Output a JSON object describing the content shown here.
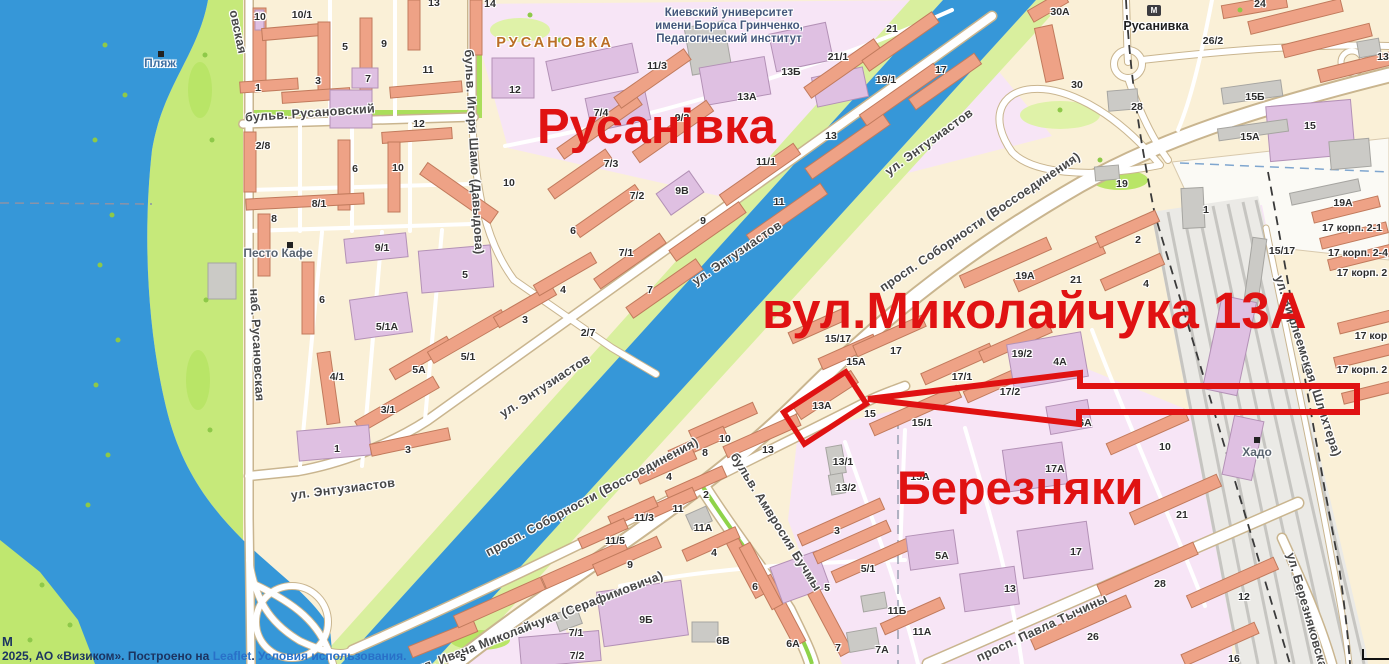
{
  "annotations": {
    "rusanivka_text": "Русанівка",
    "street_text": "вул.Миколайчука 13А",
    "bereznyaky_text": "Березняки",
    "color": "#e01212"
  },
  "attribution": {
    "m": "М",
    "prefix": "2025, АО «Визиком». Построено на ",
    "leaflet_link": "Leaflet",
    "separator": ". ",
    "terms_link": "Условия использования."
  },
  "map_labels": [
    {
      "t": "бульв. Русановский",
      "x": 310,
      "y": 113,
      "k": "st",
      "r": -4
    },
    {
      "t": "наб. Русановская",
      "x": 257,
      "y": 345,
      "k": "st",
      "r": 87
    },
    {
      "t": "овская",
      "x": 238,
      "y": 32,
      "k": "st",
      "r": 78
    },
    {
      "t": "бульв. Игоря Шамо (Давыдова)",
      "x": 474,
      "y": 152,
      "k": "st",
      "r": 87
    },
    {
      "t": "ул. Энтузиастов",
      "x": 929,
      "y": 142,
      "k": "st",
      "r": -36
    },
    {
      "t": "ул. Энтузиастов",
      "x": 737,
      "y": 253,
      "k": "st",
      "r": -34
    },
    {
      "t": "ул. Энтузиастов",
      "x": 545,
      "y": 386,
      "k": "st",
      "r": -33
    },
    {
      "t": "ул. Энтузиастов",
      "x": 343,
      "y": 489,
      "k": "st",
      "r": -7
    },
    {
      "t": "просп. Соборности (Воссоединения)",
      "x": 980,
      "y": 222,
      "k": "st",
      "r": -34
    },
    {
      "t": "просп. Соборности (Воссоединения)",
      "x": 592,
      "y": 497,
      "k": "st",
      "r": -28
    },
    {
      "t": "бульв. Амвросия Бучмы",
      "x": 776,
      "y": 522,
      "k": "st",
      "r": 58
    },
    {
      "t": "ул. Ивана Миколайчука (Серафимовича)",
      "x": 540,
      "y": 622,
      "k": "st",
      "r": -21
    },
    {
      "t": "просп. Павла Тычины",
      "x": 1042,
      "y": 628,
      "k": "st",
      "r": -25
    },
    {
      "t": "ул. Березняковская",
      "x": 1308,
      "y": 614,
      "k": "st",
      "r": 74
    },
    {
      "t": "ул. Вифлеемская (Шлихтера)",
      "x": 1308,
      "y": 366,
      "k": "st",
      "r": 72
    },
    {
      "t": "РУСАНОВКА",
      "x": 555,
      "y": 43,
      "k": "dist"
    },
    {
      "t": "Киевский университет",
      "x": 729,
      "y": 13,
      "k": "uni"
    },
    {
      "t": "имени Бориса Гринченко,",
      "x": 729,
      "y": 26,
      "k": "uni"
    },
    {
      "t": "Педагогический институт",
      "x": 729,
      "y": 39,
      "k": "uni"
    },
    {
      "t": "Русанивка",
      "x": 1156,
      "y": 26,
      "k": "metro"
    },
    {
      "t": "Песто Кафе",
      "x": 278,
      "y": 253,
      "k": "poi"
    },
    {
      "t": "Хадо",
      "x": 1257,
      "y": 452,
      "k": "poi"
    },
    {
      "t": "Пляж",
      "x": 160,
      "y": 63,
      "k": "beach"
    },
    {
      "t": "10",
      "x": 260,
      "y": 17,
      "k": "n"
    },
    {
      "t": "10/1",
      "x": 302,
      "y": 15,
      "k": "n"
    },
    {
      "t": "5",
      "x": 345,
      "y": 47,
      "k": "n"
    },
    {
      "t": "9",
      "x": 384,
      "y": 44,
      "k": "n"
    },
    {
      "t": "13",
      "x": 434,
      "y": 3,
      "k": "n"
    },
    {
      "t": "14",
      "x": 490,
      "y": 4,
      "k": "n"
    },
    {
      "t": "1",
      "x": 258,
      "y": 88,
      "k": "n"
    },
    {
      "t": "3",
      "x": 318,
      "y": 81,
      "k": "n"
    },
    {
      "t": "7",
      "x": 368,
      "y": 79,
      "k": "n"
    },
    {
      "t": "11",
      "x": 428,
      "y": 70,
      "k": "n"
    },
    {
      "t": "12",
      "x": 515,
      "y": 90,
      "k": "n"
    },
    {
      "t": "2/8",
      "x": 263,
      "y": 146,
      "k": "n"
    },
    {
      "t": "12",
      "x": 419,
      "y": 124,
      "k": "n"
    },
    {
      "t": "6",
      "x": 355,
      "y": 169,
      "k": "n"
    },
    {
      "t": "10",
      "x": 398,
      "y": 168,
      "k": "n"
    },
    {
      "t": "8/1",
      "x": 319,
      "y": 204,
      "k": "n"
    },
    {
      "t": "8",
      "x": 274,
      "y": 219,
      "k": "n"
    },
    {
      "t": "10",
      "x": 509,
      "y": 183,
      "k": "n"
    },
    {
      "t": "9/1",
      "x": 382,
      "y": 248,
      "k": "n"
    },
    {
      "t": "11/3",
      "x": 657,
      "y": 66,
      "k": "n"
    },
    {
      "t": "7/4",
      "x": 601,
      "y": 113,
      "k": "n"
    },
    {
      "t": "9/2",
      "x": 682,
      "y": 118,
      "k": "n"
    },
    {
      "t": "13А",
      "x": 747,
      "y": 97,
      "k": "n"
    },
    {
      "t": "13Б",
      "x": 791,
      "y": 72,
      "k": "n"
    },
    {
      "t": "21/1",
      "x": 838,
      "y": 57,
      "k": "n"
    },
    {
      "t": "21",
      "x": 892,
      "y": 29,
      "k": "n"
    },
    {
      "t": "19/1",
      "x": 886,
      "y": 80,
      "k": "n"
    },
    {
      "t": "17",
      "x": 941,
      "y": 70,
      "k": "n"
    },
    {
      "t": "13",
      "x": 831,
      "y": 136,
      "k": "n"
    },
    {
      "t": "11/1",
      "x": 766,
      "y": 162,
      "k": "n"
    },
    {
      "t": "7/3",
      "x": 611,
      "y": 164,
      "k": "n"
    },
    {
      "t": "7/2",
      "x": 637,
      "y": 196,
      "k": "n"
    },
    {
      "t": "9В",
      "x": 682,
      "y": 191,
      "k": "n"
    },
    {
      "t": "11",
      "x": 779,
      "y": 202,
      "k": "n"
    },
    {
      "t": "9",
      "x": 703,
      "y": 221,
      "k": "n"
    },
    {
      "t": "7/1",
      "x": 626,
      "y": 253,
      "k": "n"
    },
    {
      "t": "7",
      "x": 650,
      "y": 290,
      "k": "n"
    },
    {
      "t": "6",
      "x": 573,
      "y": 231,
      "k": "n"
    },
    {
      "t": "2/7",
      "x": 588,
      "y": 333,
      "k": "n"
    },
    {
      "t": "5",
      "x": 465,
      "y": 275,
      "k": "n"
    },
    {
      "t": "6",
      "x": 322,
      "y": 300,
      "k": "n"
    },
    {
      "t": "5/1А",
      "x": 387,
      "y": 327,
      "k": "n"
    },
    {
      "t": "5А",
      "x": 419,
      "y": 370,
      "k": "n"
    },
    {
      "t": "5/1",
      "x": 468,
      "y": 357,
      "k": "n"
    },
    {
      "t": "3",
      "x": 525,
      "y": 320,
      "k": "n"
    },
    {
      "t": "4",
      "x": 563,
      "y": 290,
      "k": "n"
    },
    {
      "t": "4/1",
      "x": 337,
      "y": 377,
      "k": "n"
    },
    {
      "t": "3/1",
      "x": 388,
      "y": 410,
      "k": "n"
    },
    {
      "t": "1",
      "x": 337,
      "y": 449,
      "k": "n"
    },
    {
      "t": "3",
      "x": 408,
      "y": 450,
      "k": "n"
    },
    {
      "t": "15/17",
      "x": 838,
      "y": 339,
      "k": "n"
    },
    {
      "t": "19А",
      "x": 1025,
      "y": 276,
      "k": "n"
    },
    {
      "t": "21",
      "x": 1076,
      "y": 280,
      "k": "n"
    },
    {
      "t": "5",
      "x": 463,
      "y": 658,
      "k": "n"
    },
    {
      "t": "9",
      "x": 630,
      "y": 565,
      "k": "n"
    },
    {
      "t": "7/1",
      "x": 576,
      "y": 633,
      "k": "n"
    },
    {
      "t": "7/2",
      "x": 577,
      "y": 656,
      "k": "n"
    },
    {
      "t": "9Б",
      "x": 646,
      "y": 620,
      "k": "n"
    },
    {
      "t": "6В",
      "x": 723,
      "y": 641,
      "k": "n"
    },
    {
      "t": "6",
      "x": 755,
      "y": 587,
      "k": "n"
    },
    {
      "t": "6А",
      "x": 793,
      "y": 644,
      "k": "n"
    },
    {
      "t": "5",
      "x": 827,
      "y": 588,
      "k": "n"
    },
    {
      "t": "5/1",
      "x": 868,
      "y": 569,
      "k": "n"
    },
    {
      "t": "7",
      "x": 838,
      "y": 648,
      "k": "n"
    },
    {
      "t": "7А",
      "x": 882,
      "y": 650,
      "k": "n"
    },
    {
      "t": "11Б",
      "x": 897,
      "y": 611,
      "k": "n"
    },
    {
      "t": "11А",
      "x": 922,
      "y": 632,
      "k": "n"
    },
    {
      "t": "10",
      "x": 725,
      "y": 439,
      "k": "n"
    },
    {
      "t": "8",
      "x": 705,
      "y": 453,
      "k": "n"
    },
    {
      "t": "13",
      "x": 768,
      "y": 450,
      "k": "n"
    },
    {
      "t": "4",
      "x": 669,
      "y": 477,
      "k": "n"
    },
    {
      "t": "2",
      "x": 706,
      "y": 495,
      "k": "n"
    },
    {
      "t": "11",
      "x": 678,
      "y": 509,
      "k": "n"
    },
    {
      "t": "11/3",
      "x": 644,
      "y": 518,
      "k": "n"
    },
    {
      "t": "11/5",
      "x": 615,
      "y": 541,
      "k": "n"
    },
    {
      "t": "11А",
      "x": 703,
      "y": 528,
      "k": "n"
    },
    {
      "t": "4",
      "x": 714,
      "y": 553,
      "k": "n"
    },
    {
      "t": "13/1",
      "x": 843,
      "y": 462,
      "k": "n"
    },
    {
      "t": "13/2",
      "x": 846,
      "y": 488,
      "k": "n"
    },
    {
      "t": "3",
      "x": 837,
      "y": 531,
      "k": "n"
    },
    {
      "t": "15/1",
      "x": 922,
      "y": 423,
      "k": "n"
    },
    {
      "t": "15",
      "x": 870,
      "y": 414,
      "k": "n"
    },
    {
      "t": "13А",
      "x": 822,
      "y": 406,
      "k": "n"
    },
    {
      "t": "17/1",
      "x": 962,
      "y": 377,
      "k": "n"
    },
    {
      "t": "17/2",
      "x": 1010,
      "y": 392,
      "k": "n"
    },
    {
      "t": "19/2",
      "x": 1022,
      "y": 354,
      "k": "n"
    },
    {
      "t": "17",
      "x": 896,
      "y": 351,
      "k": "n"
    },
    {
      "t": "15А",
      "x": 856,
      "y": 362,
      "k": "n"
    },
    {
      "t": "15А",
      "x": 920,
      "y": 477,
      "k": "n"
    },
    {
      "t": "4А",
      "x": 1060,
      "y": 362,
      "k": "n"
    },
    {
      "t": "6А",
      "x": 1085,
      "y": 423,
      "k": "n"
    },
    {
      "t": "17А",
      "x": 1055,
      "y": 469,
      "k": "n"
    },
    {
      "t": "17",
      "x": 1076,
      "y": 552,
      "k": "n"
    },
    {
      "t": "5А",
      "x": 942,
      "y": 556,
      "k": "n"
    },
    {
      "t": "13",
      "x": 1010,
      "y": 589,
      "k": "n"
    },
    {
      "t": "10",
      "x": 1165,
      "y": 447,
      "k": "n"
    },
    {
      "t": "21",
      "x": 1182,
      "y": 515,
      "k": "n"
    },
    {
      "t": "28",
      "x": 1160,
      "y": 584,
      "k": "n"
    },
    {
      "t": "26",
      "x": 1093,
      "y": 637,
      "k": "n"
    },
    {
      "t": "12",
      "x": 1244,
      "y": 597,
      "k": "n"
    },
    {
      "t": "16",
      "x": 1234,
      "y": 659,
      "k": "n"
    },
    {
      "t": "15Б",
      "x": 1255,
      "y": 97,
      "k": "n"
    },
    {
      "t": "15",
      "x": 1310,
      "y": 126,
      "k": "n"
    },
    {
      "t": "15А",
      "x": 1250,
      "y": 137,
      "k": "n"
    },
    {
      "t": "19А",
      "x": 1343,
      "y": 203,
      "k": "n"
    },
    {
      "t": "15/17",
      "x": 1282,
      "y": 251,
      "k": "n"
    },
    {
      "t": "13",
      "x": 1383,
      "y": 57,
      "k": "n"
    },
    {
      "t": "24",
      "x": 1260,
      "y": 4,
      "k": "n"
    },
    {
      "t": "26/2",
      "x": 1213,
      "y": 41,
      "k": "n"
    },
    {
      "t": "30А",
      "x": 1060,
      "y": 12,
      "k": "n"
    },
    {
      "t": "30",
      "x": 1077,
      "y": 85,
      "k": "n"
    },
    {
      "t": "28",
      "x": 1137,
      "y": 107,
      "k": "n"
    },
    {
      "t": "19",
      "x": 1122,
      "y": 184,
      "k": "n"
    },
    {
      "t": "1",
      "x": 1206,
      "y": 210,
      "k": "n"
    },
    {
      "t": "2",
      "x": 1138,
      "y": 240,
      "k": "n"
    },
    {
      "t": "4",
      "x": 1146,
      "y": 284,
      "k": "n"
    },
    {
      "t": "17 корп. 2-1",
      "x": 1352,
      "y": 228,
      "k": "n"
    },
    {
      "t": "17 корп. 2-4",
      "x": 1358,
      "y": 253,
      "k": "n"
    },
    {
      "t": "17 корп. 2",
      "x": 1362,
      "y": 273,
      "k": "n"
    },
    {
      "t": "17 кор",
      "x": 1371,
      "y": 336,
      "k": "n"
    },
    {
      "t": "17 корп. 2",
      "x": 1362,
      "y": 370,
      "k": "n"
    }
  ],
  "icons": [
    {
      "k": "sq",
      "x": 158,
      "y": 51
    },
    {
      "k": "sq",
      "x": 287,
      "y": 242
    },
    {
      "k": "sq",
      "x": 1254,
      "y": 437
    },
    {
      "k": "metro",
      "x": 1147,
      "y": 5
    }
  ]
}
